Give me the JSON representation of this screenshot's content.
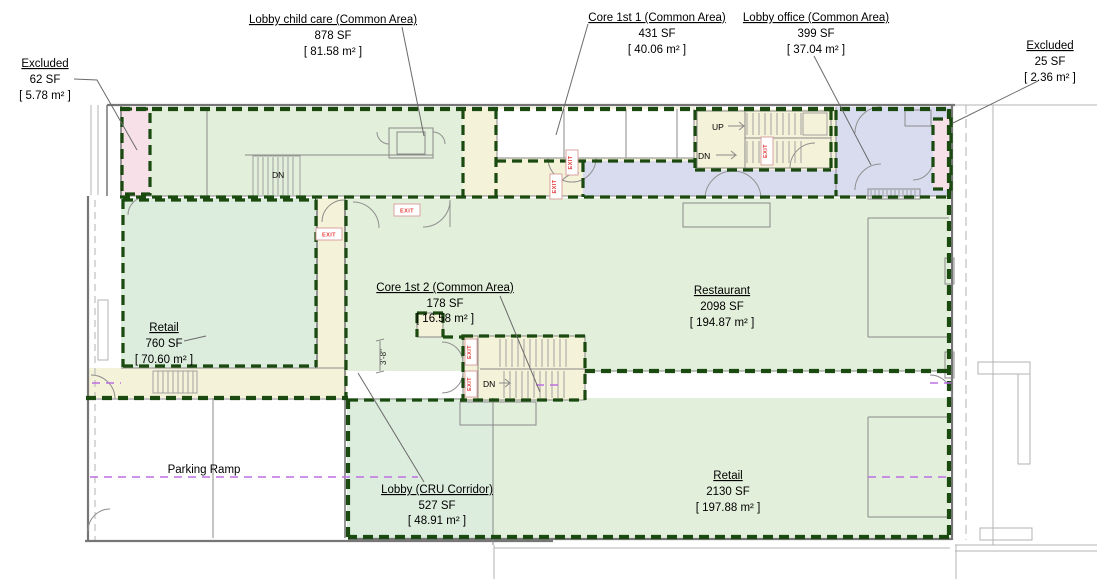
{
  "drawing": {
    "title": "First floor area plan",
    "areas": {
      "excluded_left": {
        "name": "Excluded",
        "sf": "62 SF",
        "m2": "[ 5.78 m² ]"
      },
      "lobby_child_care": {
        "name": "Lobby child care (Common Area)",
        "sf": "878 SF",
        "m2": "[ 81.58 m² ]"
      },
      "core_1st_1": {
        "name": "Core 1st 1 (Common Area)",
        "sf": "431 SF",
        "m2": "[ 40.06 m² ]"
      },
      "lobby_office": {
        "name": "Lobby office (Common Area)",
        "sf": "399 SF",
        "m2": "[ 37.04 m² ]"
      },
      "excluded_right": {
        "name": "Excluded",
        "sf": "25 SF",
        "m2": "[ 2.36 m² ]"
      },
      "core_1st_2": {
        "name": "Core 1st 2 (Common Area)",
        "sf": "178 SF",
        "m2": "[ 16.58 m² ]"
      },
      "restaurant": {
        "name": "Restaurant",
        "sf": "2098 SF",
        "m2": "[ 194.87 m² ]"
      },
      "retail_west": {
        "name": "Retail",
        "sf": "760 SF",
        "m2": "[ 70.60 m² ]"
      },
      "lobby_cru": {
        "name": "Lobby (CRU Corridor)",
        "sf": "527 SF",
        "m2": "[ 48.91 m² ]"
      },
      "retail_east": {
        "name": "Retail",
        "sf": "2130 SF",
        "m2": "[ 197.88 m² ]"
      },
      "parking_ramp": {
        "name": "Parking Ramp"
      }
    },
    "annotations": {
      "up": "UP",
      "dn": "DN",
      "exit": "EXIT",
      "dim_3_8": "3'-8\""
    },
    "colors": {
      "boundary_green": "#1a4a0f",
      "included_green": "#e2efda",
      "included_green_alt": "#dcecdd",
      "common_cream": "#f4f2d8",
      "office_lavender": "#d9dcee",
      "excluded_pink": "#f7e0e7",
      "ramp_purple": "#bd6ee3",
      "exit_red": "#e23b3b",
      "wall_gray": "#8a8a8a"
    }
  }
}
